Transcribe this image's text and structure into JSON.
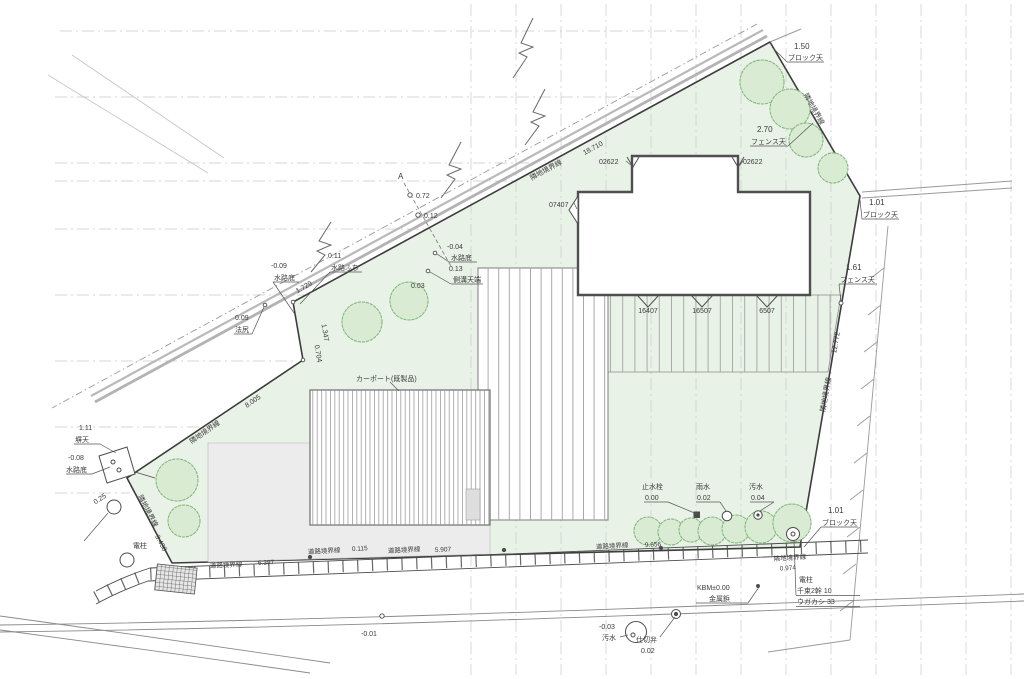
{
  "boundaries": {
    "north_name": "隣地境界線",
    "north_len": "18.710",
    "ne_name": "隣地境界線",
    "east_name": "隣地境界線",
    "east_len": "12.772",
    "west_upper_name": "隣地境界線",
    "west_upper_len": "8.005",
    "west_lower_name": "隣地境界線",
    "west_lower_len": "3.438",
    "se_name": "隣地境界線",
    "se_len": "0.974",
    "road1_name": "道路境界線",
    "road1_len": "6.397",
    "road2_name": "道路境界線",
    "road2_len": "0.115",
    "road3_name": "道路境界線",
    "road3_len": "5.907",
    "road4_name": "道路境界線",
    "road4_len": "9.656",
    "seg1": "1.729",
    "seg2": "1.347",
    "seg3": "0.704"
  },
  "levels": {
    "v150": "1.50",
    "d150": "ブロック天",
    "v270": "2.70",
    "d270": "フェンス天",
    "v101a": "1.01",
    "d101a": "ブロック天",
    "v161": "1.61",
    "d161": "フェンス天",
    "v101b": "1.01",
    "d101b": "ブロック天",
    "v072": "0.72",
    "v012": "0.12",
    "vm004": "-0.04",
    "dm004": "水路底",
    "v013": "0.13",
    "d013": "側溝天端",
    "v011": "0.11",
    "d011": "水路ふち",
    "vm009": "-0.09",
    "dm009": "水路底",
    "v009": "0.09",
    "d009": "法尻",
    "v003": "0.03",
    "v111": "1.11",
    "d111": "塀天",
    "vm008": "-0.08",
    "dm008": "水路底",
    "v025": "0.25",
    "vm001": "-0.01",
    "vm003": "-0.03",
    "dm003": "汚水"
  },
  "services": {
    "stop_valve_label": "止水栓",
    "stop_valve_value": "0.00",
    "rain_label": "雨水",
    "rain_value": "0.02",
    "sewer_label": "汚水",
    "sewer_value": "0.04",
    "gate_valve_label": "仕切弁",
    "gate_valve_value": "0.02",
    "kbm_label": "KBM±0.00",
    "kbm_sub": "金属鋲",
    "pole_left_label": "電柱",
    "pole_right_label": "電柱",
    "pole_right_line1": "千束2幹 10",
    "pole_right_line2": "ウガカシ 33"
  },
  "building": {
    "window_code_left": "02622",
    "window_code_right": "02622",
    "door_code_side": "07407",
    "door_code_1": "16407",
    "door_code_2": "16507",
    "door_code_3": "6507",
    "carport_label": "カーポート(既製品)"
  },
  "markers": {
    "section_a": "A"
  },
  "colors": {
    "site_green": "#e9f2e7",
    "tree_green": "#d9ecd3",
    "line_dark": "#3c3c3c",
    "paving_gray": "#ececec"
  }
}
